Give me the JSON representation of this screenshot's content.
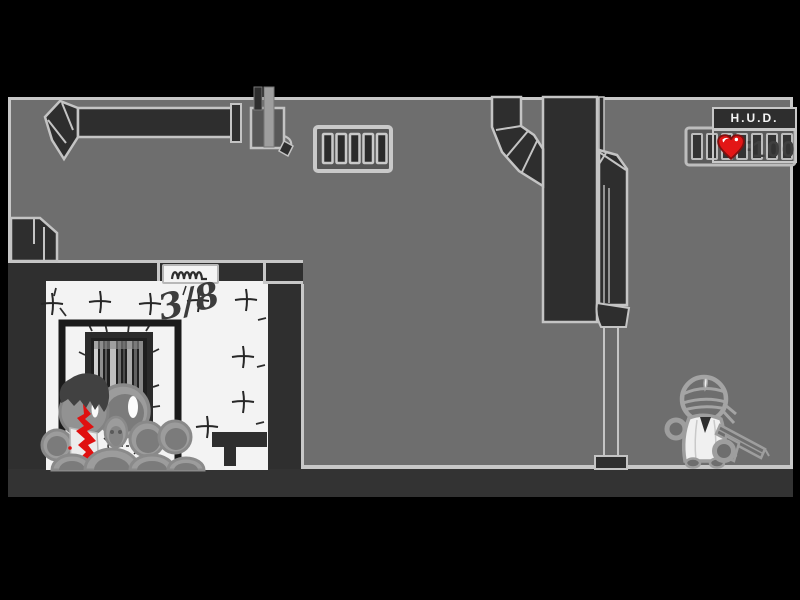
{
  "hud": {
    "title": "H.U.D.",
    "separator": ":",
    "health": "100",
    "heart_icon": "heart-icon",
    "heart_color": "#e31616"
  },
  "scene": {
    "graffiti": "3/8"
  },
  "colors": {
    "background": "#000000",
    "wall_gray": "#6e6e6e",
    "structure_dark": "#2e2e2e",
    "outline_light": "#c8c8c8",
    "room_white": "#f3f3f3",
    "shadow_dark": "#333333",
    "blood_red": "#e01010",
    "heart_red": "#e31616"
  }
}
